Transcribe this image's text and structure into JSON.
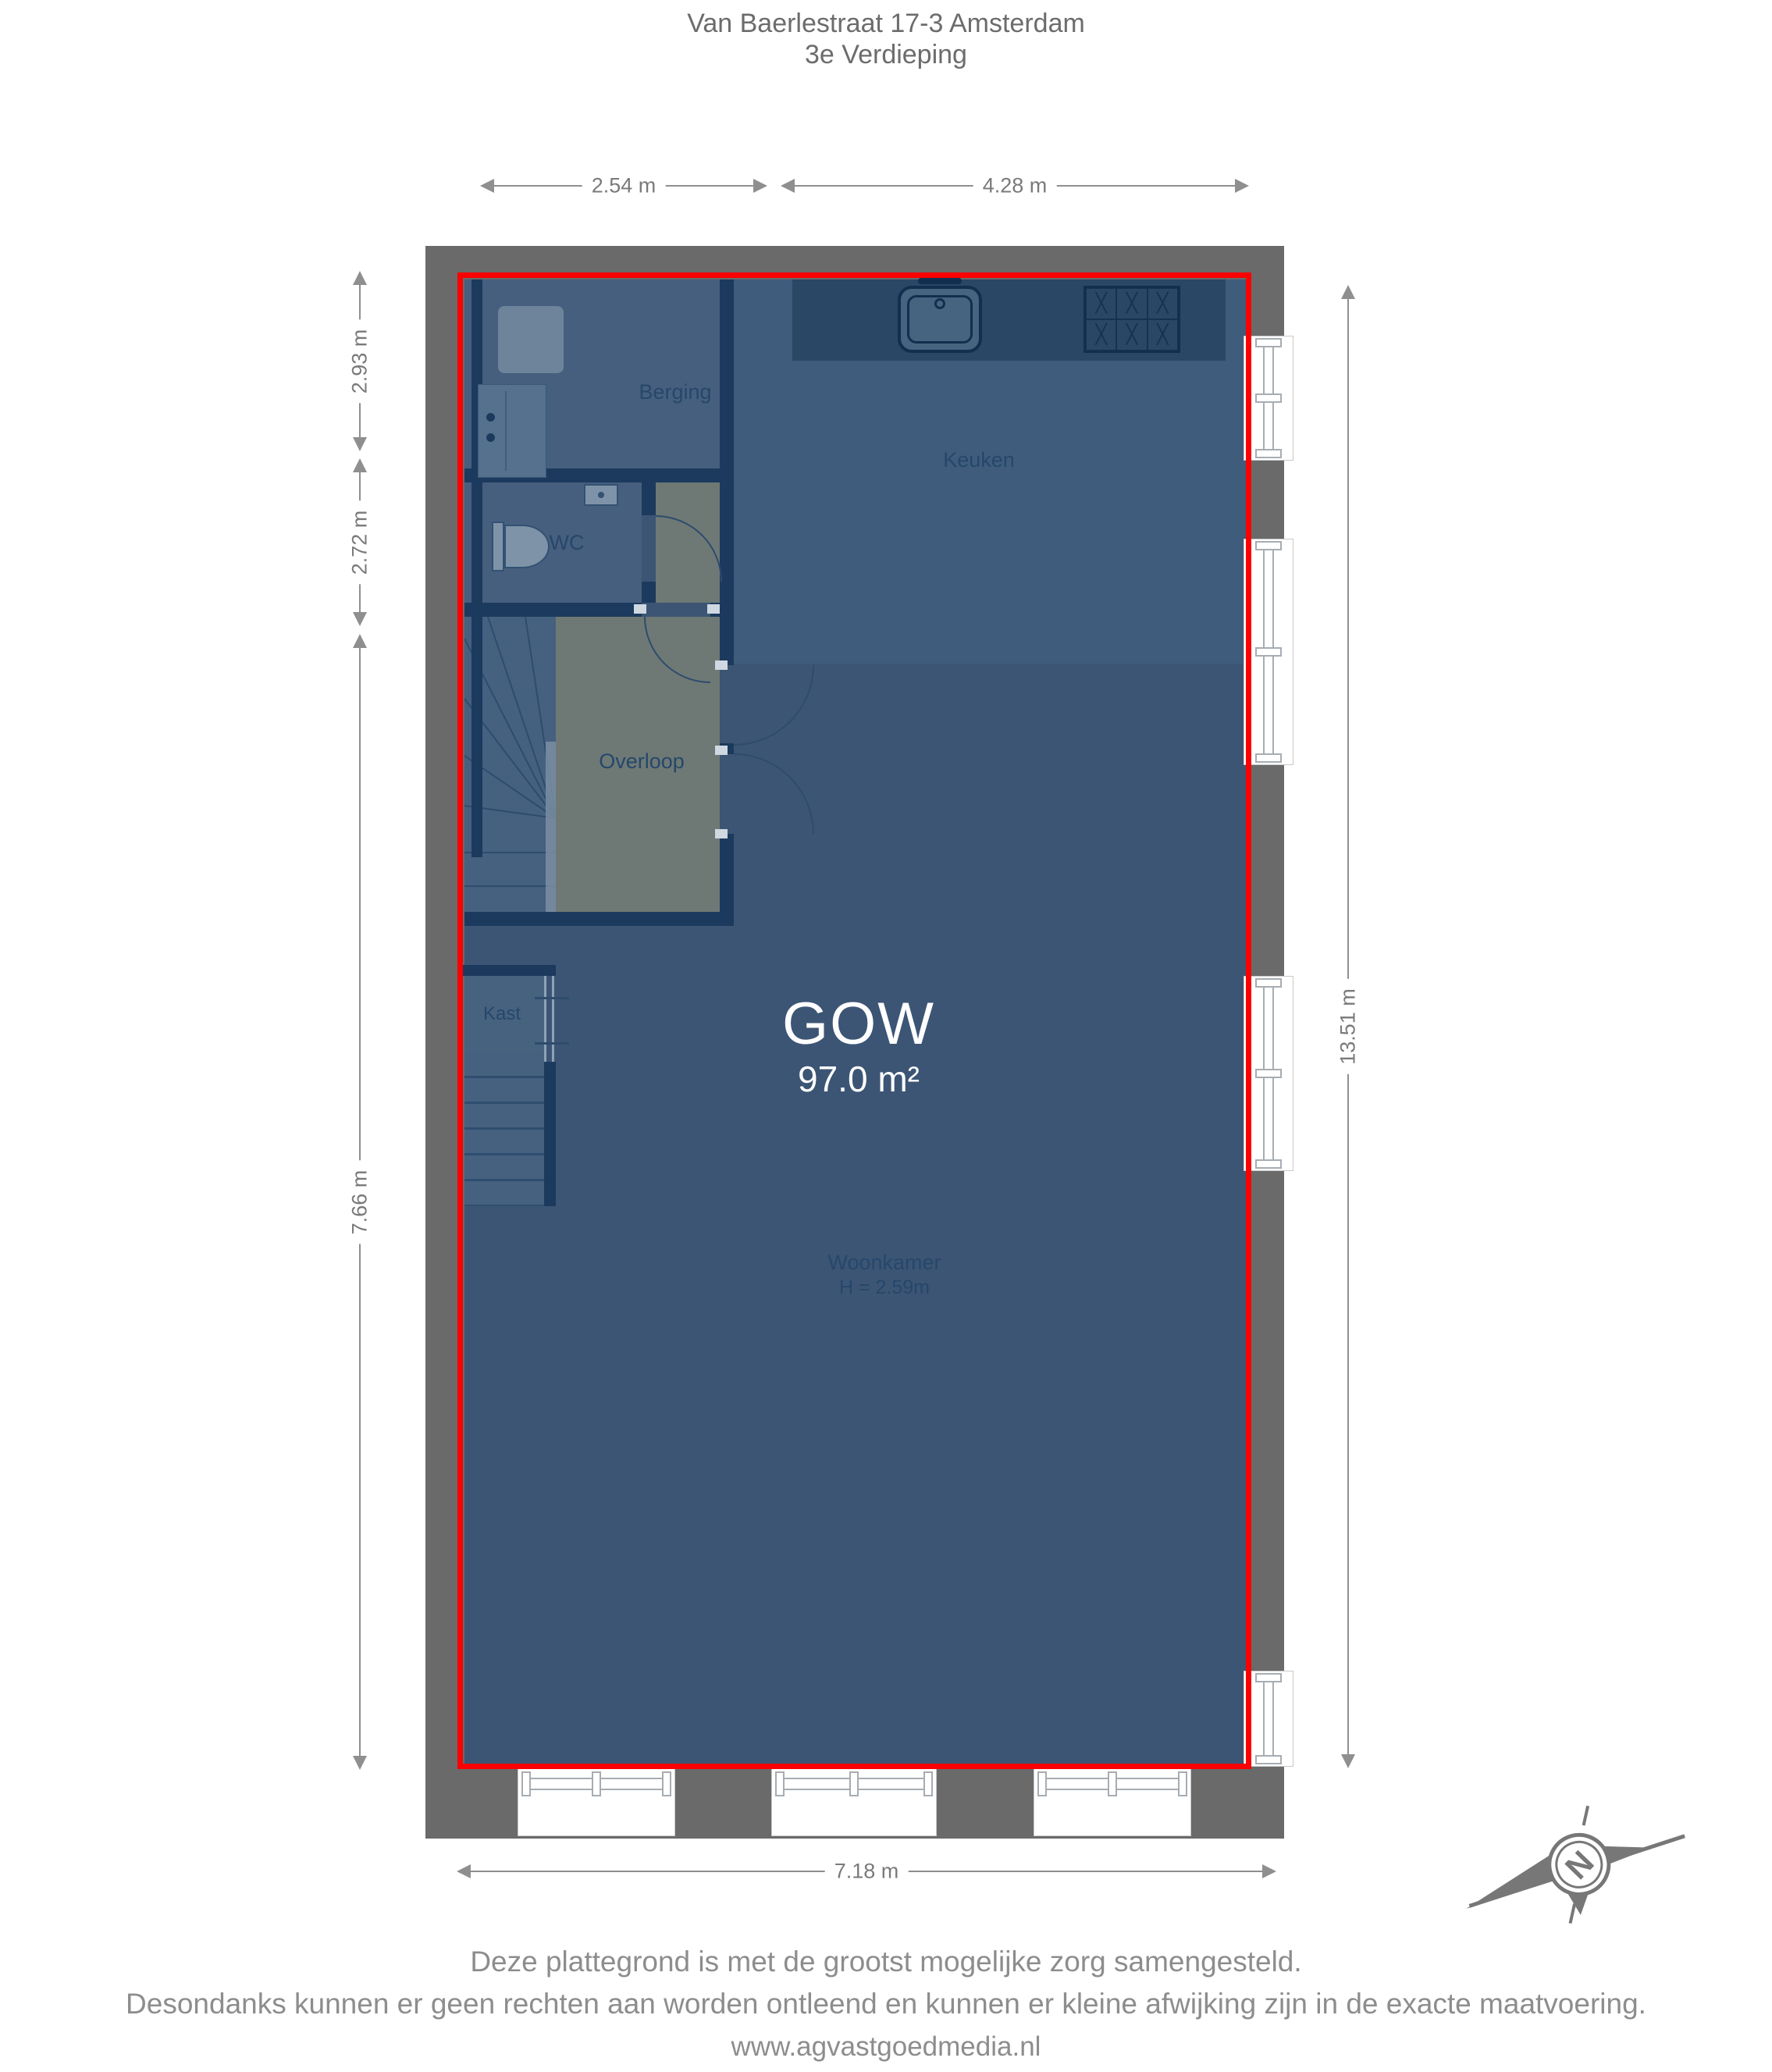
{
  "title": {
    "line1": "Van Baerlestraat 17-3 Amsterdam",
    "line2": "3e Verdieping"
  },
  "dimensions": {
    "top1": "2.54 m",
    "top2": "4.28 m",
    "left1": "2.93 m",
    "left2": "2.72 m",
    "left3": "7.66 m",
    "right1": "13.51 m",
    "bottom1": "7.18 m"
  },
  "rooms": {
    "berging": "Berging",
    "wc": "WC",
    "keuken": "Keuken",
    "overloop": "Overloop",
    "kast": "Kast",
    "woonkamer": "Woonkamer",
    "woonkamer_height": "H = 2.59m"
  },
  "area": {
    "code": "GOW",
    "size": "97.0 m²"
  },
  "footer": {
    "line1": "Deze plattegrond is met de grootst mogelijke zorg samengesteld.",
    "line2": "Desondanks kunnen er geen rechten aan worden ontleend en kunnen er kleine afwijking zijn in de exacte maatvoering.",
    "line3": "www.agvastgoedmedia.nl"
  },
  "compass": {
    "letter": "N"
  },
  "colors": {
    "outline_red": "#fb0000",
    "wall_gray": "#6a6a6a",
    "interior_wall_navy": "#1c3a5d",
    "floor_woonkamer": "#3c5574",
    "floor_keuken": "#3f5c7c",
    "floor_berging": "#465f7e",
    "floor_overloop": "#6e7975",
    "counter_navy": "#2a4765",
    "label_navy": "#26476b",
    "dimension_gray": "#7a7a7a",
    "area_text_white": "#ffffff"
  },
  "icons": {
    "compass": "compass-rose-icon",
    "washing_machine": "washing-machine-icon",
    "berging_counter": "counter-icon",
    "toilet": "toilet-icon",
    "wc_sink": "sink-icon",
    "kitchen_sink": "kitchen-sink-icon",
    "stove": "stove-icon",
    "stairs_winder": "winder-stairs-icon",
    "stairs_straight": "straight-stairs-icon",
    "window": "window-icon"
  }
}
